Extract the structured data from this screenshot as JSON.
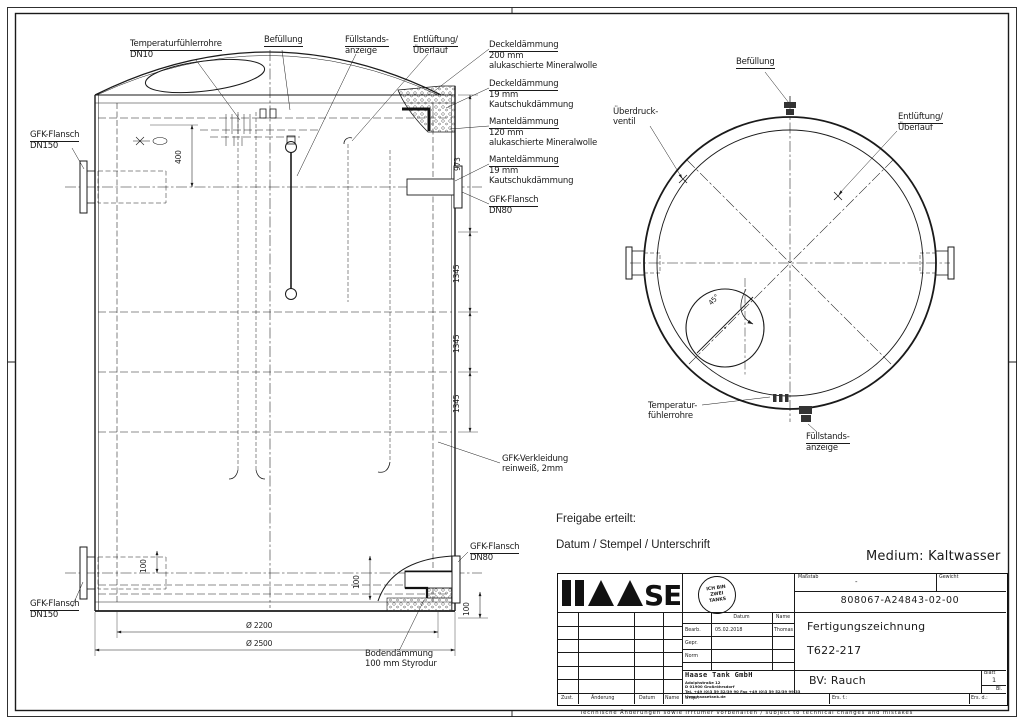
{
  "front_view": {
    "labels": {
      "temp": [
        "Temperaturfühlerrohre",
        "DN10"
      ],
      "befuellung": [
        "Befüllung"
      ],
      "fuellstand": [
        "Füllstands-",
        "anzeige"
      ],
      "entlueftung": [
        "Entlüftung/",
        "Überlauf"
      ],
      "deckel1": [
        "Deckeldämmung",
        "200 mm",
        "alukaschierte Mineralwolle"
      ],
      "deckel2": [
        "Deckeldämmung",
        "19 mm",
        "Kautschukdämmung"
      ],
      "mantel1": [
        "Manteldämmung",
        "120 mm",
        "alukaschierte Mineralwolle"
      ],
      "mantel2": [
        "Manteldämmung",
        "19 mm",
        "Kautschukdämmung"
      ],
      "flansch_dn80_right": [
        "GFK-Flansch",
        "DN80"
      ],
      "flansch_dn150_top": [
        "GFK-Flansch",
        "DN150"
      ],
      "flansch_dn150_bottom": [
        "GFK-Flansch",
        "DN150"
      ],
      "verkleidung": [
        "GFK-Verkleidung",
        "reinweiß, 2mm"
      ],
      "flansch_dn80_bottom": [
        "GFK-Flansch",
        "DN80"
      ],
      "boden": [
        "Bodendämmung",
        "100 mm Styrodur"
      ]
    },
    "dims": {
      "h400": "400",
      "h973": "973",
      "h1345_1": "1345",
      "h1345_2": "1345",
      "h1345_3": "1345",
      "v100_left": "100",
      "v100_mid": "100",
      "v100_right": "100",
      "dia_2200": "Ø 2200",
      "dia_2500": "Ø 2500"
    }
  },
  "top_view": {
    "labels": {
      "befuellung": [
        "Befüllung"
      ],
      "ueberdruck": [
        "Überdruck-",
        "ventil"
      ],
      "entlueftung": [
        "Entlüftung/",
        "Überlauf"
      ],
      "temp": [
        "Temperatur-",
        "fühlerrohre"
      ],
      "fuellstand": [
        "Füllstands-",
        "anzeige"
      ]
    },
    "dims": {
      "angle": "45°"
    }
  },
  "release": {
    "freigabe": "Freigabe erteilt:",
    "stempel": "Datum / Stempel / Unterschrift",
    "medium": "Medium: Kaltwasser"
  },
  "title_block": {
    "logo_se": "SE",
    "stamp": [
      "ICH BIN",
      "ZWEI",
      "TANKS"
    ],
    "masstab_label": "Maßstab",
    "masstab_value": "-",
    "gewicht_label": "Gewicht",
    "drawing_number": "808067-A24843-02-00",
    "col_datum": "Datum",
    "col_name": "Name",
    "row_bearb": "Bearb.",
    "bearb_datum": "05.02.2018",
    "bearb_name": "Thomas",
    "row_gepr": "Gepr.",
    "row_norm": "Norm",
    "company": "Haase Tank GmbH",
    "address": [
      "Adolphstraße 12",
      "D 01900 Großröhrsdorf",
      "Tel. +49 (0)3 59 52/39 90   Fax +49 (0)3 59 52/39 99 33",
      "www.haasetank.de"
    ],
    "title1": "Fertigungszeichnung",
    "title2": "T622-217",
    "bv": "BV: Rauch",
    "blatt_label": "Blatt",
    "blatt_value": "1",
    "bl_label": "Bl.",
    "zust": "Zust.",
    "aenderung": "Änderung",
    "datum": "Datum",
    "name": "Name",
    "urspr": "Urspr.",
    "ers_f": "Ers. f.:",
    "ers_d": "Ers. d.:",
    "note": "Technische Änderungen sowie Irrtümer vorbehalten / subject to technical changes and mistakes"
  }
}
